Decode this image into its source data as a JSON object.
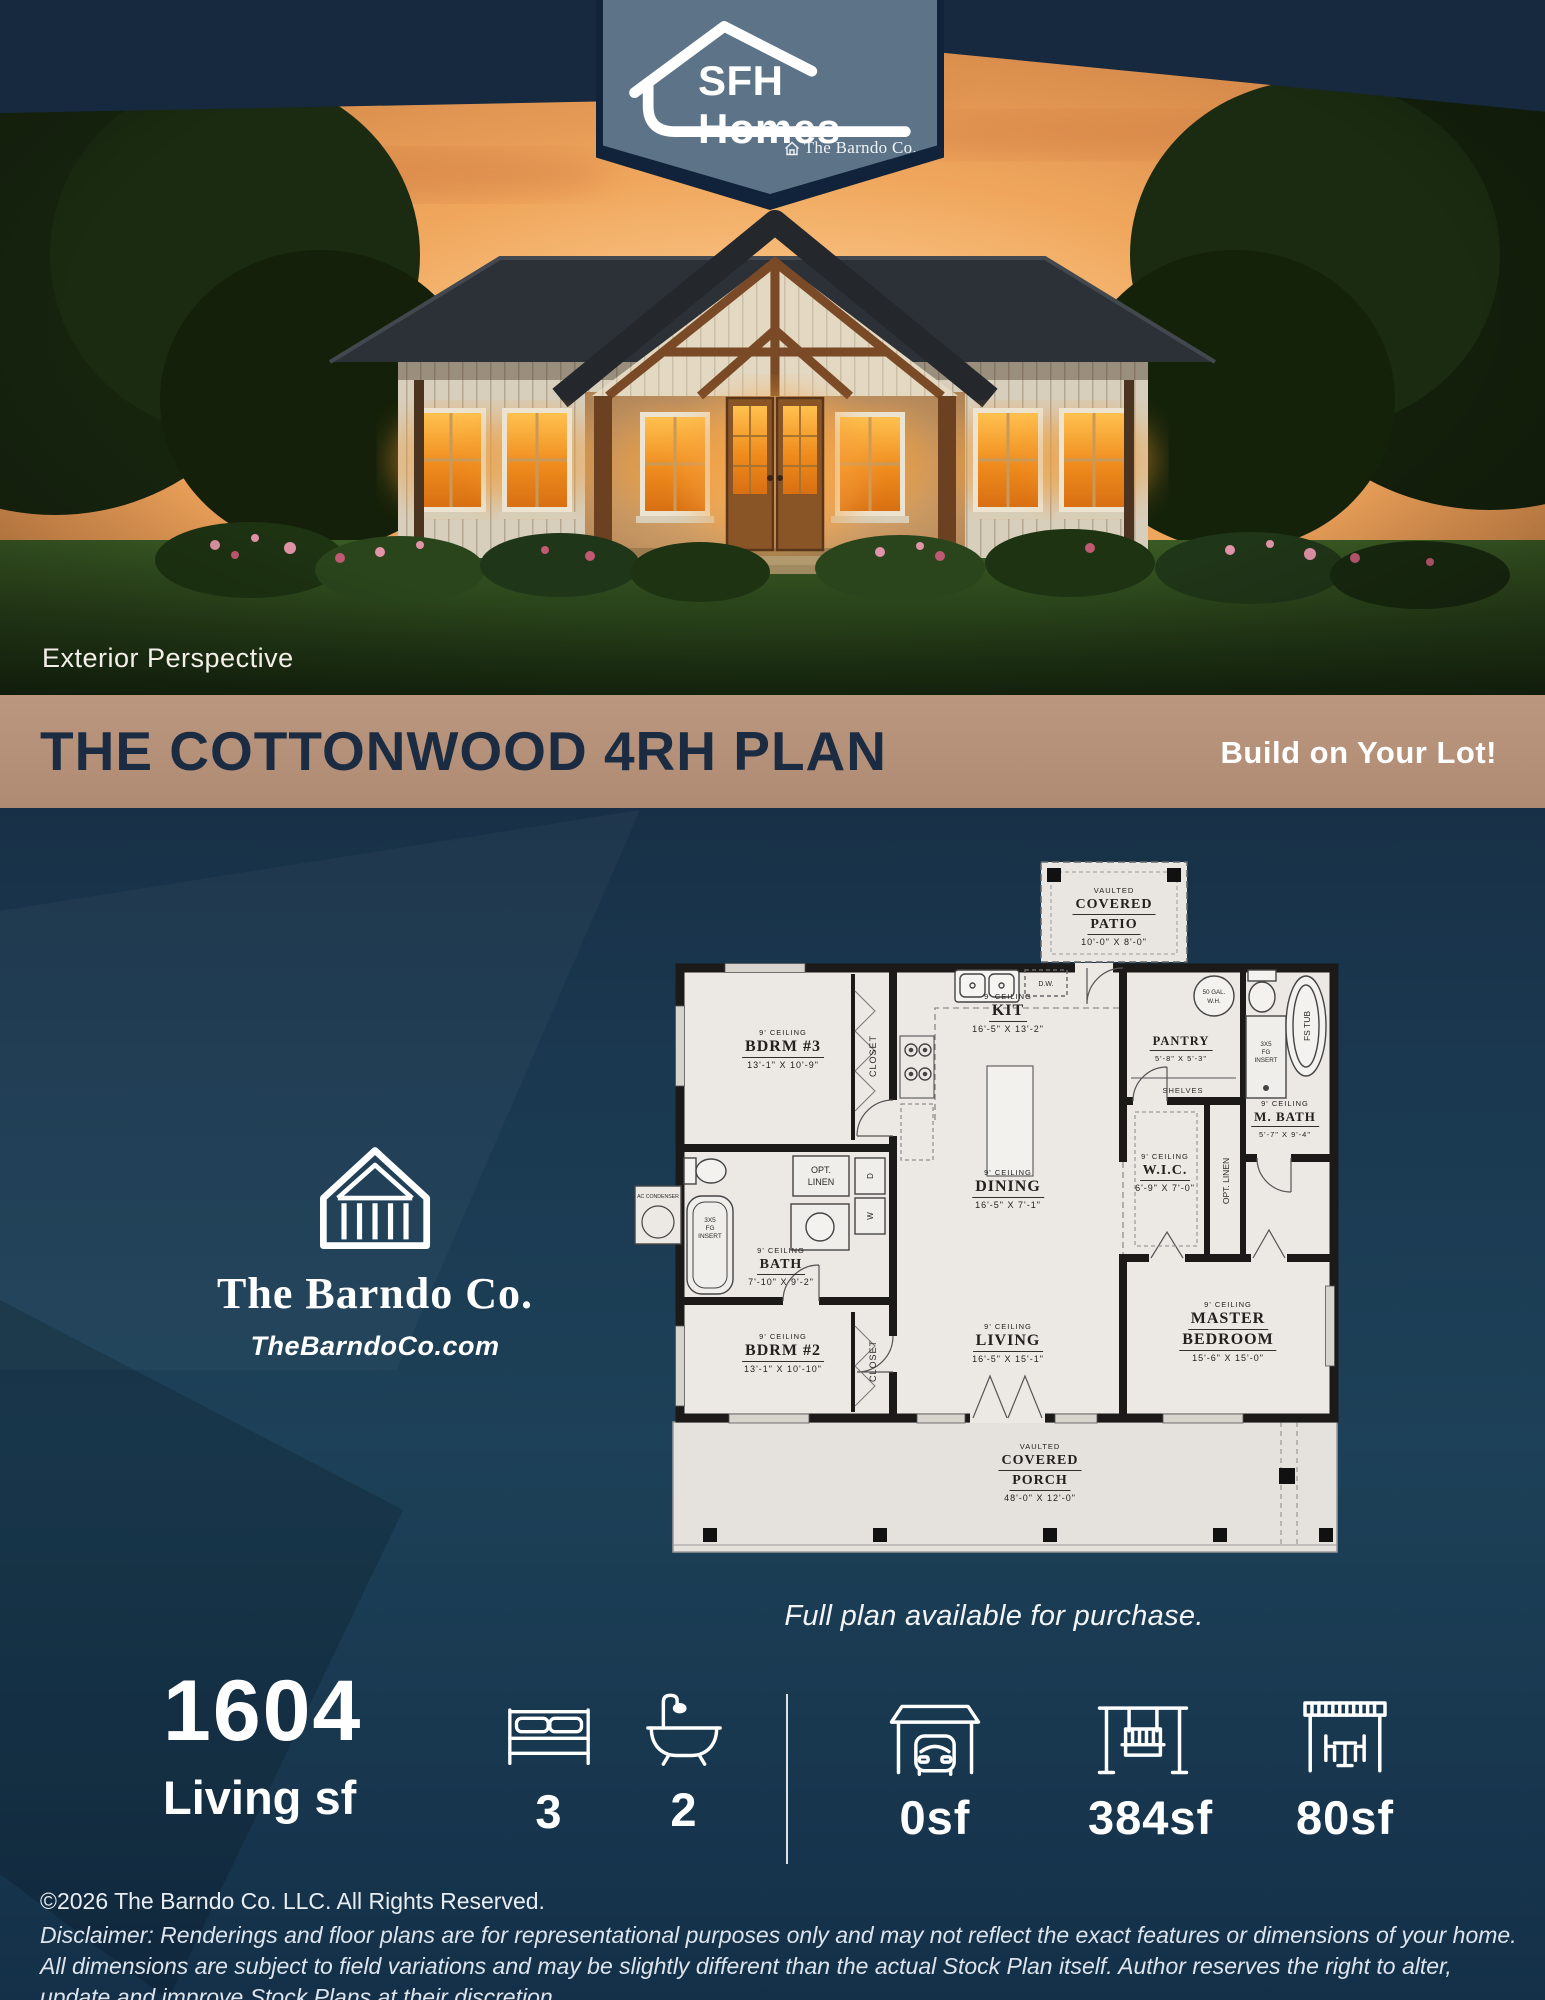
{
  "badge": {
    "brand": "SFH Homes",
    "sub_brand": "The Barndo Co."
  },
  "photo": {
    "caption": "Exterior Perspective"
  },
  "banner": {
    "title": "THE COTTONWOOD 4RH PLAN",
    "cta": "Build on Your Lot!"
  },
  "brand_block": {
    "name": "The Barndo Co.",
    "website": "TheBarndoCo.com"
  },
  "plan": {
    "caption": "Full plan available for purchase.",
    "rooms": {
      "patio": {
        "tag": "VAULTED",
        "line1": "COVERED",
        "line2": "PATIO",
        "dims": "10'-0\" X 8'-0\""
      },
      "bdrm3": {
        "ceiling": "9' CEILING",
        "name": "BDRM #3",
        "dims": "13'-1\" X 10'-9\""
      },
      "kit": {
        "ceiling": "9' CEILING",
        "name": "KIT",
        "dims": "16'-5\" X 13'-2\""
      },
      "pantry": {
        "name": "PANTRY",
        "dims": "5'-8\" X 5'-3\""
      },
      "mbath": {
        "ceiling": "9' CEILING",
        "name": "M. BATH",
        "dims": "5'-7\" X 9'-4\""
      },
      "wic": {
        "ceiling": "9' CEILING",
        "name": "W.I.C.",
        "dims": "6'-9\" X 7'-0\""
      },
      "dining": {
        "ceiling": "9' CEILING",
        "name": "DINING",
        "dims": "16'-5\" X 7'-1\""
      },
      "bath": {
        "ceiling": "9' CEILING",
        "name": "BATH",
        "dims": "7'-10\" X 9'-2\""
      },
      "bdrm2": {
        "ceiling": "9' CEILING",
        "name": "BDRM #2",
        "dims": "13'-1\" X 10'-10\""
      },
      "living": {
        "ceiling": "9' CEILING",
        "name": "LIVING",
        "dims": "16'-5\" X 15'-1\""
      },
      "master": {
        "ceiling": "9' CEILING",
        "name1": "MASTER",
        "name2": "BEDROOM",
        "dims": "15'-6\" X 15'-0\""
      },
      "porch": {
        "tag": "VAULTED",
        "line1": "COVERED",
        "line2": "PORCH",
        "dims": "48'-0\" X 12'-0\""
      }
    },
    "labels": {
      "closet": "CLOSET",
      "shelves": "SHELVES",
      "opt1": "OPT.",
      "opt2": "LINEN",
      "opt_linen": "OPT. LINEN",
      "wh1": "50 GAL.",
      "wh2": "W.H.",
      "dw": "D.W.",
      "fg1": "3X5",
      "fg2": "FG",
      "fg3": "INSERT",
      "fstub": "FS TUB",
      "washer": "W",
      "dryer": "D",
      "ac": "AC CONDENSER"
    }
  },
  "stats": {
    "living_value": "1604",
    "living_label": "Living sf",
    "beds": "3",
    "baths": "2",
    "garage": "0sf",
    "porch": "384sf",
    "patio": "80sf"
  },
  "footer": {
    "copyright": "©2026 The Barndo Co. LLC. All Rights Reserved.",
    "disclaimer": "Disclaimer: Renderings and floor plans are for representational purposes only and may not reflect the exact features or dimensions of your home. All dimensions are subject to field variations and may be slightly different than the actual Stock Plan itself. Author reserves the right to alter, update and improve Stock Plans at their discretion."
  },
  "colors": {
    "navy": "#16293e",
    "badge": "#5d7488",
    "banner_tan": "#b6927d",
    "paper": "#ece9e5"
  }
}
